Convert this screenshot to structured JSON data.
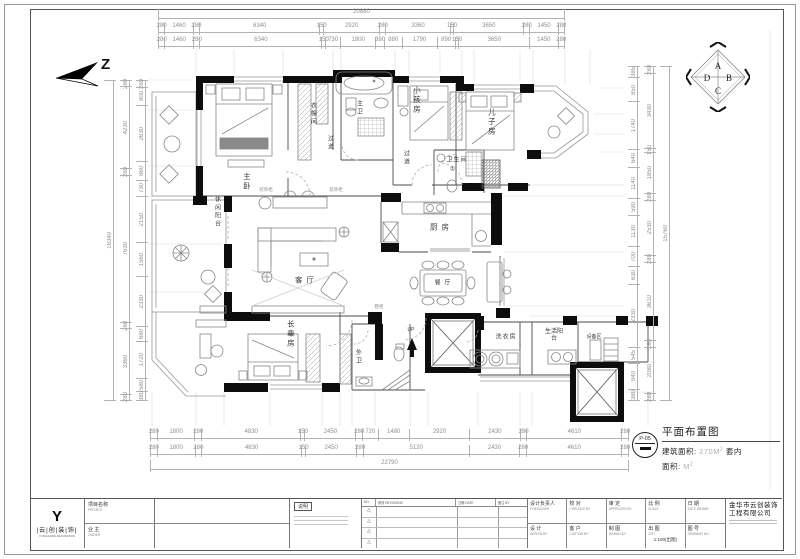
{
  "north": {
    "label": "Z"
  },
  "compass": {
    "top": "A",
    "right": "B",
    "bottom": "C",
    "left": "D"
  },
  "rooms": {
    "master": "主卧",
    "cloak": "衣帽间",
    "master_bath": "主卫",
    "corridor1": "过道",
    "corridor2": "过道",
    "kids": "小孩房",
    "son": "儿子房",
    "bath2": "卫生间",
    "bath2_num": "①",
    "kitchen": "厨 房",
    "living": "客 厅",
    "dining": "餐 厅",
    "leisure_balcony": "休闲阳台",
    "elders": "长辈房",
    "outer_bath": "外卫",
    "laundry": "洗衣房",
    "service_balcony": "生活阳台",
    "equipment": "设备区",
    "up": "UP"
  },
  "labels": {
    "cabinet1": "装饰柜",
    "cabinet2": "装饰柜",
    "shoe": "鞋柜"
  },
  "dims": {
    "top_total": "20880",
    "top_row1": [
      "280",
      "1460",
      "280",
      "6340",
      "150",
      "2920",
      "280",
      "3360",
      "150",
      "3650",
      "280",
      "1450",
      "280"
    ],
    "top_row2": [
      "280",
      "1460",
      "280",
      "6340",
      "150",
      "730",
      "1800",
      "390",
      "880",
      "1790",
      "890",
      "150",
      "3650",
      "1450",
      "280"
    ],
    "bottom_row1": [
      "280",
      "1800",
      "280",
      "4830",
      "150",
      "2450",
      "280",
      "720",
      "1480",
      "2920",
      "2430",
      "280",
      "4610",
      "280"
    ],
    "bottom_row2": [
      "280",
      "1800",
      "280",
      "4830",
      "150",
      "2450",
      "280",
      "5120",
      "2430",
      "280",
      "4610",
      "280"
    ],
    "bottom_total": "22790",
    "left_total": "16340",
    "left_outer": [
      "280",
      "4230",
      "280",
      "7630",
      "280",
      "3360",
      "280"
    ],
    "left_inner": [
      "280",
      "800",
      "2630",
      "860",
      "730",
      "2150",
      "1560",
      "2330",
      "680",
      "1720",
      "580",
      "380"
    ],
    "right_total": "15760",
    "right_outer": [
      "280",
      "3430",
      "150",
      "1850",
      "280",
      "2530",
      "280",
      "3610",
      "280",
      "2080",
      "280"
    ],
    "right_inner": [
      "385",
      "850",
      "1740",
      "640",
      "1140",
      "590",
      "1130",
      "700",
      "630",
      "2330",
      "545",
      "940",
      "380"
    ]
  },
  "drawing_info": {
    "number": "P-05",
    "title": "平面布置图",
    "area_label": "建筑面积:",
    "area_value": "270M",
    "area_sup": "2",
    "suite_label": "套内",
    "suite_label2": "面积:",
    "suite_value": "M",
    "suite_sup": "2"
  },
  "title_block": {
    "logo_glyph": "Y",
    "logo_name": "|云|创|装|饰|",
    "logo_sub": "YUNCHUANG DECORATION",
    "project_label": "项目名称",
    "project_en": "PROJECT",
    "owner_label": "业 主",
    "owner_en": "OWNER",
    "notes_title": "说明",
    "revision": {
      "no": "NO.",
      "col_rev": "修改 REVISIONS",
      "col_date": "日期 DATE",
      "col_by": "备注 BY",
      "marks": [
        "△",
        "△",
        "△",
        "△"
      ]
    },
    "cells": [
      {
        "cn": "设计负责人",
        "en": "F.DESIGNER"
      },
      {
        "cn": "校 对",
        "en": "CHECKED BY"
      },
      {
        "cn": "审 定",
        "en": "APPROVED BY"
      },
      {
        "cn": "比 例",
        "en": "SCALE"
      },
      {
        "cn": "日 期",
        "en": "DATE DRAWN"
      },
      {
        "cn": "设 计",
        "en": "DESIGN BY"
      },
      {
        "cn": "客 户",
        "en": "CUSTOM BY"
      },
      {
        "cn": "制 图",
        "en": "DRAWN BY"
      },
      {
        "cn": "出 图",
        "en": "2017",
        "val": "1:100(出图)"
      },
      {
        "cn": "图 号",
        "en": "DRAWING NO."
      }
    ],
    "company_line1": "金华市云创装饰",
    "company_line2": "工程有限公司"
  }
}
